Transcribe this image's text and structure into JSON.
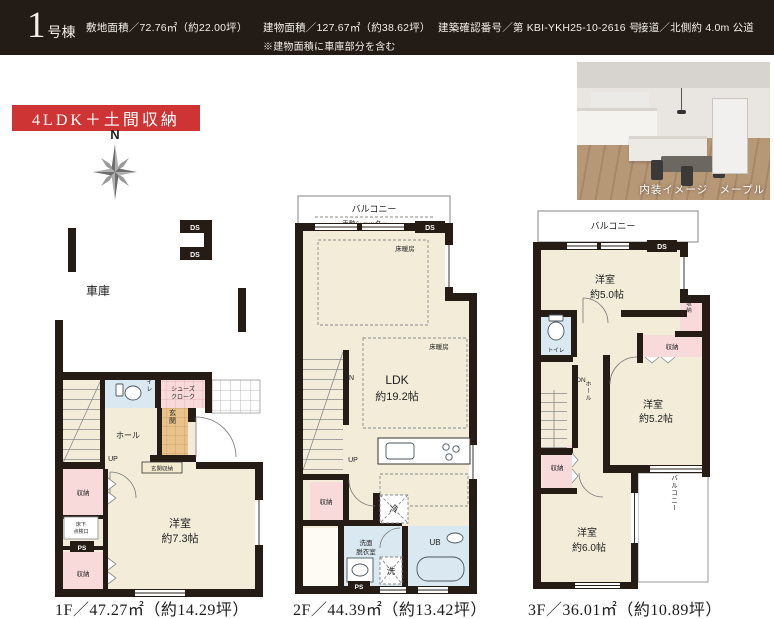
{
  "header": {
    "unit_number": "1",
    "unit_suffix": "号棟",
    "spec_site_area": "敷地面積／72.76㎡（約22.00坪）",
    "spec_building_area": "建物面積／127.67㎡（約38.62坪）",
    "spec_building_note": "※建物面積に車庫部分を含む",
    "spec_confirmation": "建築確認番号／第 KBI-YKH25-10-2616 号",
    "spec_road": "接道／北側約 4.0m 公道"
  },
  "badge": {
    "label": "4LDK＋土間収納"
  },
  "compass": {
    "north": "N"
  },
  "photo": {
    "caption": "内装イメージ　メープル"
  },
  "labels": {
    "garage": "車庫",
    "ds": "DS",
    "ps": "PS",
    "up": "UP",
    "dn": "DN",
    "hall": "ホール",
    "toilet": "トイレ",
    "storage": "収納",
    "genkan": "玄関",
    "genkan_storage": "玄関収納",
    "shoes_line1": "シューズ",
    "shoes_line2": "クローク",
    "underfloor_line1": "床下",
    "underfloor_line2": "点検口",
    "balcony": "バルコニー",
    "shutter": "手動シャッター",
    "floor_heating": "床暖房",
    "ldk": "LDK",
    "ldk_size": "約19.2帖",
    "fridge": "冷",
    "washer": "洗",
    "washroom_line1": "洗面",
    "washroom_line2": "脱衣室",
    "unit_bath": "UB",
    "room": "洋室",
    "size_7_3": "約7.3帖",
    "size_5_0": "約5.0帖",
    "size_5_2": "約5.2帖",
    "size_6_0": "約6.0帖"
  },
  "captions": {
    "f1": "1F／47.27㎡（約14.29坪）",
    "f2": "2F／44.39㎡（約13.42坪）",
    "f3": "3F／36.01㎡（約10.89坪）"
  }
}
